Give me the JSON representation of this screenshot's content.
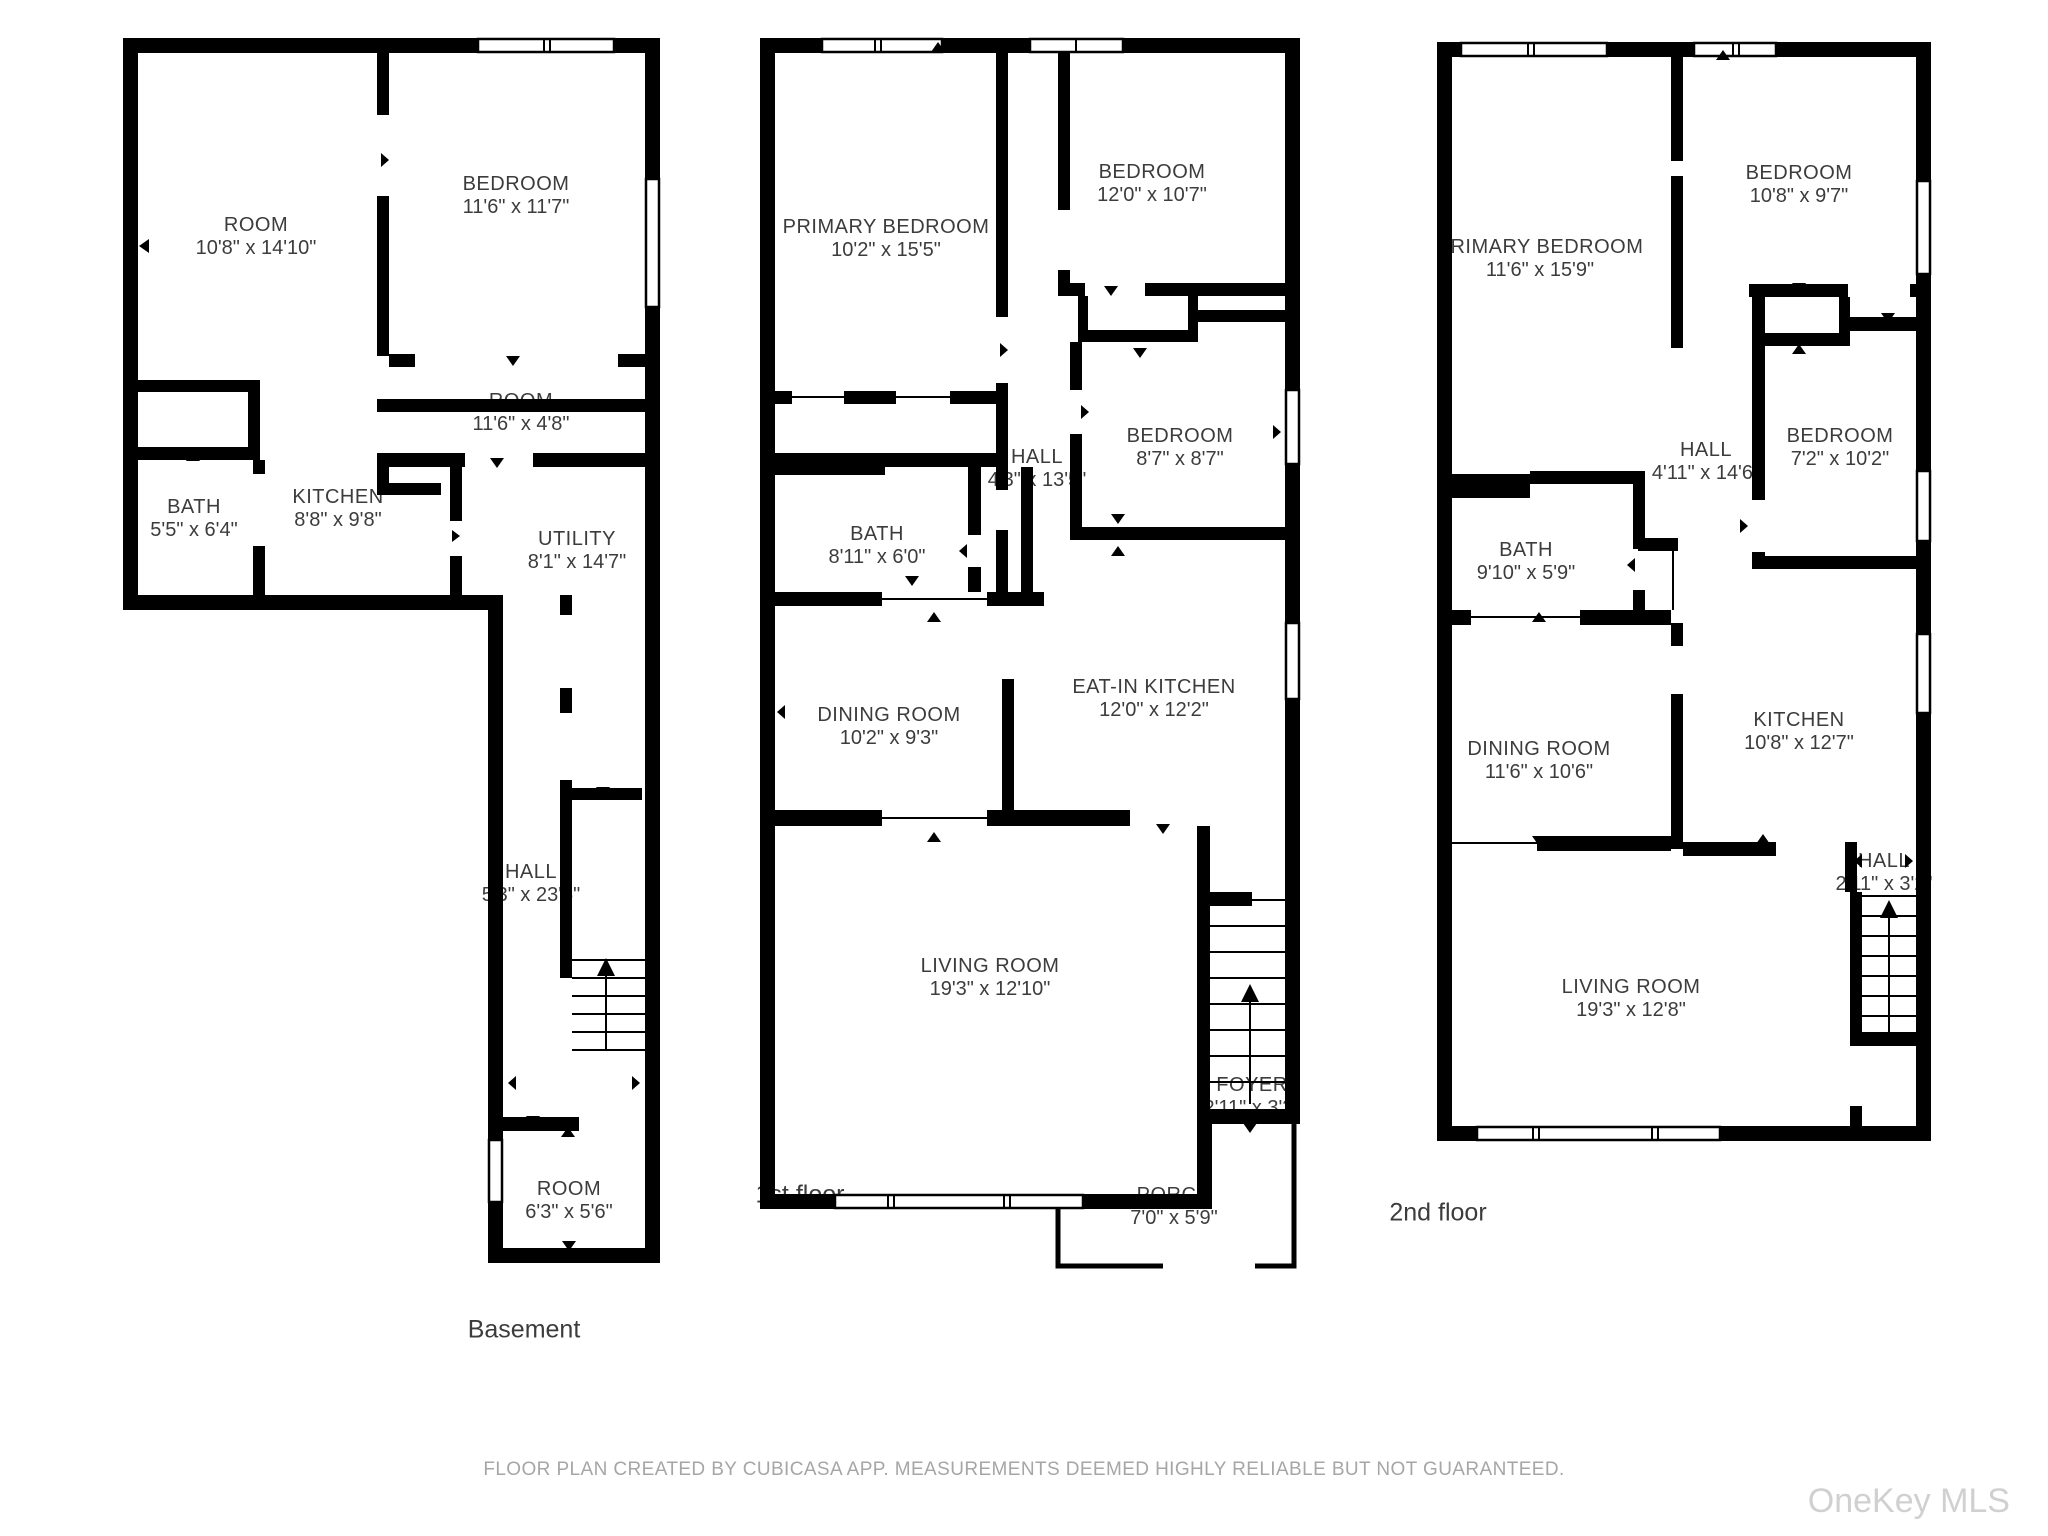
{
  "floors": [
    {
      "title": "Basement",
      "rooms": [
        {
          "name": "ROOM",
          "dims": "10'8\" x 14'10\""
        },
        {
          "name": "BEDROOM",
          "dims": "11'6\" x 11'7\""
        },
        {
          "name": "ROOM",
          "dims": "11'6\" x 4'8\""
        },
        {
          "name": "BATH",
          "dims": "5'5\" x 6'4\""
        },
        {
          "name": "KITCHEN",
          "dims": "8'8\" x 9'8\""
        },
        {
          "name": "UTILITY",
          "dims": "8'1\" x 14'7\""
        },
        {
          "name": "HALL",
          "dims": "5'3\" x 23'5\""
        },
        {
          "name": "ROOM",
          "dims": "6'3\" x 5'6\""
        }
      ]
    },
    {
      "title": "1st floor",
      "rooms": [
        {
          "name": "PRIMARY BEDROOM",
          "dims": "10'2\" x 15'5\""
        },
        {
          "name": "BEDROOM",
          "dims": "12'0\" x 10'7\""
        },
        {
          "name": "HALL",
          "dims": "4'3\" x 13'5\""
        },
        {
          "name": "BEDROOM",
          "dims": "8'7\" x 8'7\""
        },
        {
          "name": "BATH",
          "dims": "8'11\" x 6'0\""
        },
        {
          "name": "DINING ROOM",
          "dims": "10'2\" x 9'3\""
        },
        {
          "name": "EAT-IN KITCHEN",
          "dims": "12'0\" x 12'2\""
        },
        {
          "name": "LIVING ROOM",
          "dims": "19'3\" x 12'10\""
        },
        {
          "name": "FOYER",
          "dims": "2'11\" x 3'3\""
        },
        {
          "name": "PORCH",
          "dims": "7'0\" x 5'9\""
        }
      ]
    },
    {
      "title": "2nd floor",
      "rooms": [
        {
          "name": "PRIMARY BEDROOM",
          "dims": "11'6\" x 15'9\""
        },
        {
          "name": "BEDROOM",
          "dims": "10'8\" x 9'7\""
        },
        {
          "name": "HALL",
          "dims": "4'11\" x 14'6\""
        },
        {
          "name": "BEDROOM",
          "dims": "7'2\" x 10'2\""
        },
        {
          "name": "BATH",
          "dims": "9'10\" x 5'9\""
        },
        {
          "name": "DINING ROOM",
          "dims": "11'6\" x 10'6\""
        },
        {
          "name": "KITCHEN",
          "dims": "10'8\" x 12'7\""
        },
        {
          "name": "HALL",
          "dims": "2'11\" x 3'2\""
        },
        {
          "name": "LIVING ROOM",
          "dims": "19'3\" x 12'8\""
        }
      ]
    }
  ],
  "footer": {
    "disclaimer": "FLOOR PLAN CREATED BY CUBICASA APP. MEASUREMENTS DEEMED HIGHLY RELIABLE BUT NOT GUARANTEED.",
    "watermark": "OneKey MLS"
  }
}
